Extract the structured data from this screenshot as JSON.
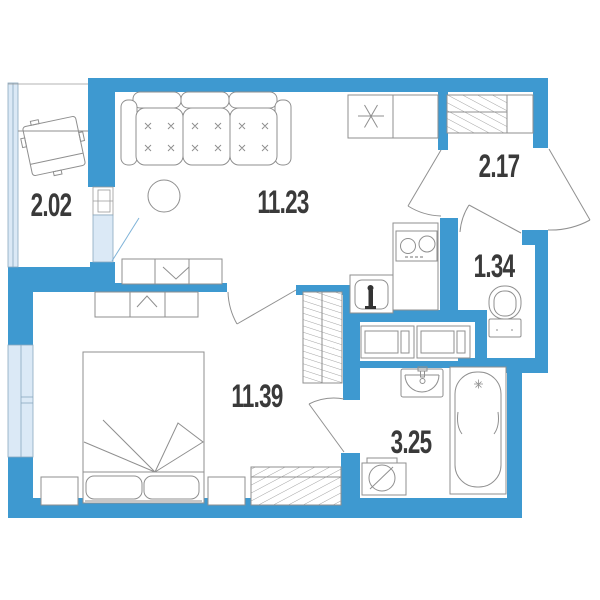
{
  "plan": {
    "type": "apartment-floor-plan",
    "rooms": [
      {
        "id": "balcony",
        "area_label": "2.02"
      },
      {
        "id": "living-kitchen",
        "area_label": "11.23"
      },
      {
        "id": "hallway",
        "area_label": "2.17"
      },
      {
        "id": "wc",
        "area_label": "1.34"
      },
      {
        "id": "bedroom",
        "area_label": "11.39"
      },
      {
        "id": "bathroom",
        "area_label": "3.25"
      }
    ],
    "colors": {
      "wall": "#3e99d0",
      "glazing_fill": "#dbe9f6",
      "glazing_frame": "#8aa8bf",
      "furniture_line": "#8f8f8f",
      "label_text": "#3a3a3a"
    },
    "icons": [
      "sofa-icon",
      "round-table-icon",
      "tv-stand-icon",
      "dresser-icon",
      "bed-icon",
      "nightstand-icon",
      "wardrobe-icon",
      "closet-icon",
      "kitchen-counter-icon",
      "stove-icon",
      "kitchen-sink-icon",
      "balcony-chair-icon",
      "appliance-icon",
      "toilet-icon",
      "bathroom-sink-icon",
      "bathtub-icon",
      "washing-machine-icon",
      "door-swing-icon",
      "window-icon"
    ]
  }
}
